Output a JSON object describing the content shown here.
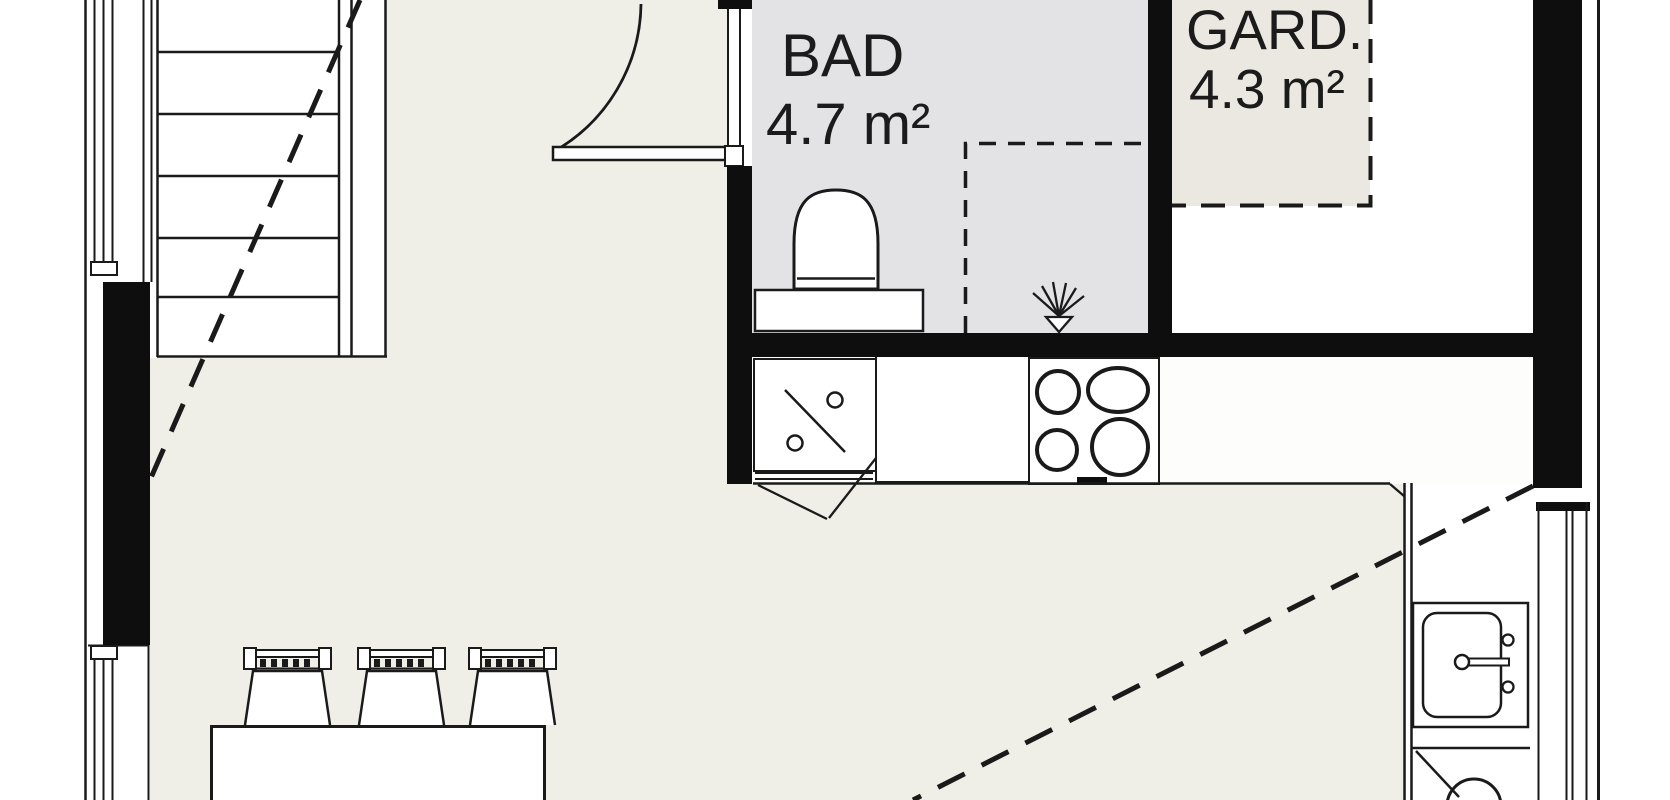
{
  "page": {
    "type": "architectural-floor-plan",
    "view": "cropped-plan-section"
  },
  "rooms": [
    {
      "name": "BAD",
      "area": "4.7 m²"
    },
    {
      "name": "GARD.",
      "area": "4.3 m²"
    }
  ],
  "fixtures": {
    "toilet": "toilet",
    "shower": "shower-corner-with-drain-symbol",
    "stove": "cooktop-4-burners",
    "dishwasher_top": "appliance-with-diagonal-symbol",
    "sink": "kitchen-sink-with-faucet",
    "appliance_bottom": "appliance-with-circle-symbol",
    "stairs": "staircase",
    "door": "door-with-swing-arc",
    "dining_table": "dining-table",
    "chairs_count": 3,
    "windows_count": 3
  },
  "colors": {
    "wall": "#0e0e0e",
    "line": "#1a1a1a",
    "floor_main": "#efeee7",
    "floor_bath": "#e3e3e6",
    "floor_gard": "#eae8e0",
    "counter": "#ffffff"
  }
}
